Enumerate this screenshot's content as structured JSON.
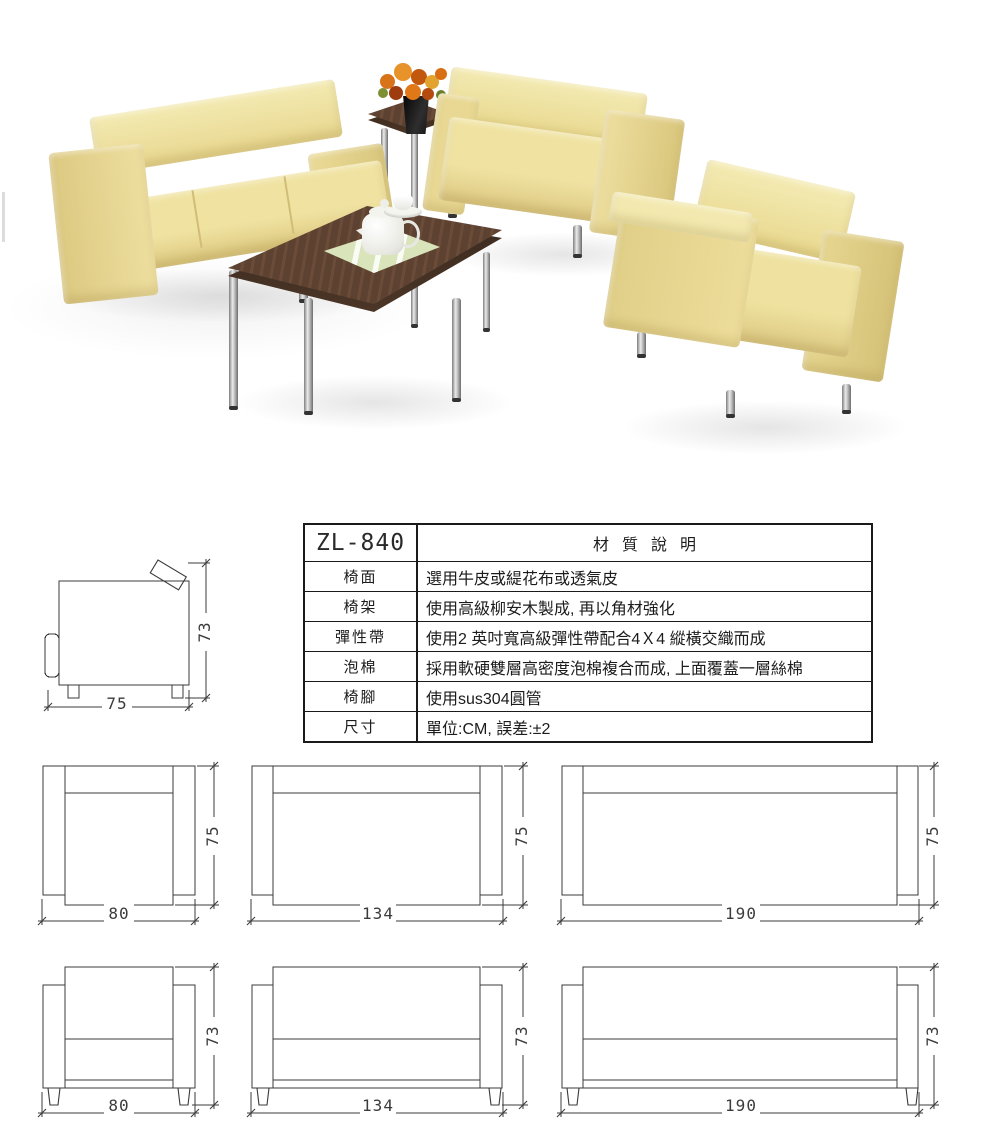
{
  "photo": {
    "colors": {
      "sofa_light": "#f2ecae",
      "sofa_mid": "#e9dd96",
      "sofa_shadow": "#c9b878",
      "wood_dark": "#5d4232",
      "chrome_light": "#ebebeb",
      "chrome_dark": "#6c6c6c",
      "flower_orange": "#e07818",
      "placemat_green": "#d9e4ba"
    }
  },
  "side_view": {
    "width_label": "75",
    "height_label": "73"
  },
  "spec_table": {
    "model": "ZL-840",
    "title": "材質說明",
    "rows": [
      {
        "label": "椅面",
        "value": "選用牛皮或緹花布或透氣皮"
      },
      {
        "label": "椅架",
        "value": "使用高級柳安木製成, 再以角材強化"
      },
      {
        "label": "彈性帶",
        "value": "使用2 英吋寬高級彈性帶配合4Ｘ4 縱橫交織而成"
      },
      {
        "label": "泡棉",
        "value": "採用軟硬雙層高密度泡棉複合而成, 上面覆蓋一層絲棉"
      },
      {
        "label": "椅腳",
        "value": "使用sus304圓管"
      },
      {
        "label": "尺寸",
        "value": "單位:CM, 誤差:±2"
      }
    ]
  },
  "drawings": {
    "top_row": [
      {
        "width_label": "80",
        "height_label": "75"
      },
      {
        "width_label": "134",
        "height_label": "75"
      },
      {
        "width_label": "190",
        "height_label": "75"
      }
    ],
    "bottom_row": [
      {
        "width_label": "80",
        "height_label": "73"
      },
      {
        "width_label": "134",
        "height_label": "73"
      },
      {
        "width_label": "190",
        "height_label": "73"
      }
    ]
  }
}
